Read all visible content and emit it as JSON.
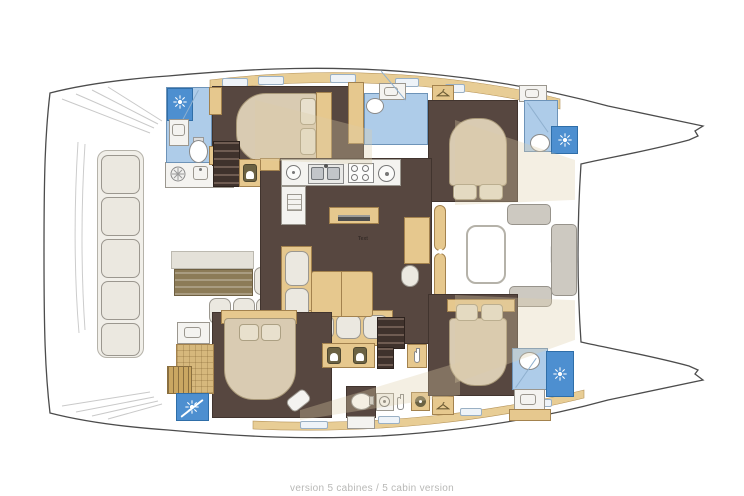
{
  "caption": "version 5 cabines / 5 cabin version",
  "labels": {
    "salon_floor_note": "Text"
  },
  "palette": {
    "background": "#ffffff",
    "outline": "#4c4c4c",
    "floor_brown": "#574740",
    "wood_tan": "#e6c88e",
    "deck_tan": "#e8cd95",
    "wood_floor": "#d6b87c",
    "bed_beige": "#d9cbb2",
    "cushion_white": "#ebe8e0",
    "cushion_gray": "#cdc9c1",
    "bath_blue_light": "#aecce9",
    "bath_blue_dark": "#4d8fd0",
    "caption_gray": "#b8b8b6"
  },
  "icons": {
    "shower": "sunburst-icon",
    "toilet": "toilet-icon",
    "sink": "basin-icon",
    "double_sink": "double-sink-icon",
    "stove": "four-burner-icon",
    "hob": "round-hob-icon",
    "grill": "grill-icon",
    "berth_locker": "berth-icon",
    "wardrobe": "hanger-icon",
    "washer": "washer-icon",
    "fridge": "fridge-icon",
    "bottle": "bottle-icon"
  }
}
